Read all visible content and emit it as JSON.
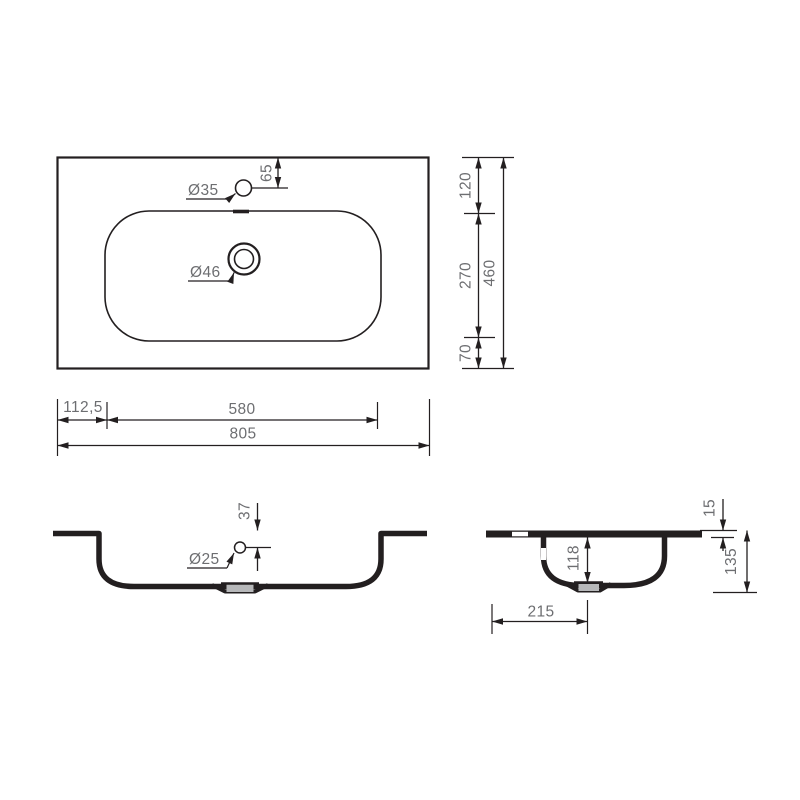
{
  "drawing": {
    "kind": "washbasin technical dimension drawing",
    "views": {
      "plan": {
        "hole_labels": {
          "faucet": "Ø35",
          "drain": "Ø46"
        },
        "dimensions": {
          "faucet_center_from_top": "65",
          "top_edge_to_bowl": "120",
          "bowl_depth": "270",
          "bowl_to_bottom_edge": "70",
          "overall_depth": "460",
          "left_edge_to_bowl": "112,5",
          "bowl_width": "580",
          "overall_width": "805"
        }
      },
      "front": {
        "hole_labels": {
          "overflow": "Ø25"
        },
        "dimensions": {
          "overflow_center_from_rim": "37"
        }
      },
      "side": {
        "dimensions": {
          "rim_thickness": "15",
          "bowl_inner_depth": "118",
          "overall_height": "135",
          "drain_center_offset": "215"
        }
      }
    },
    "colors": {
      "line": "#231f20",
      "dimension_text": "#6d6e71",
      "drain_fill": "#b7b8ba",
      "background": "#ffffff"
    }
  }
}
